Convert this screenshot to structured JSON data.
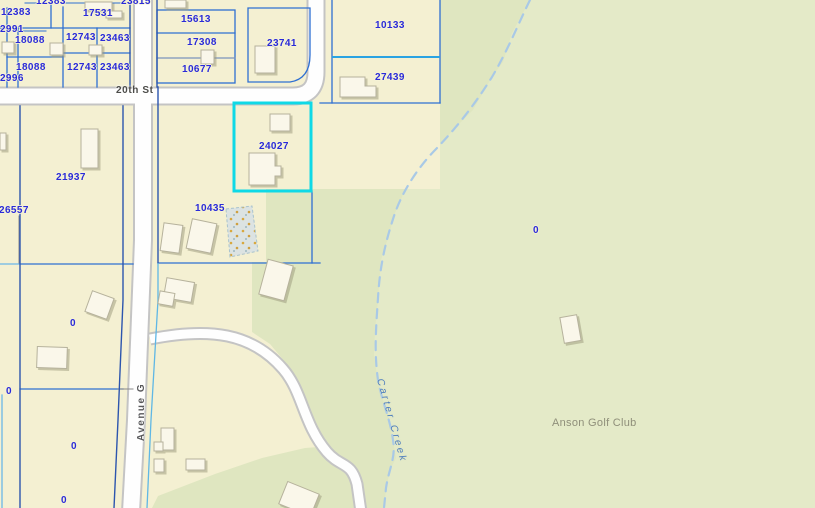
{
  "map": {
    "type": "gis-parcel-map",
    "parcel_labels": [
      "12383",
      "23815",
      "12383",
      "17531",
      "12991",
      "18088",
      "12743",
      "23463",
      "18088",
      "12743",
      "23463",
      "12996",
      "15613",
      "17308",
      "10677",
      "23741",
      "10133",
      "27439",
      "24027",
      "10435",
      "21937",
      "26557",
      "0",
      "0",
      "0",
      "0",
      "0"
    ],
    "street_labels": [
      "20th St",
      "Avenue G"
    ],
    "water_label": "Carter Creek",
    "place_label": "Anson Golf Club",
    "selected_parcel_id": "24027",
    "colors": {
      "parcel_fill": "#f4f0d2",
      "golf_fill": "#dfe6c0",
      "golf_fill_light": "#e4eac8",
      "selection_outline": "#0fd9e6",
      "parcel_line_blue": "#2e6fd2",
      "parcel_line_navy": "#2c55ae",
      "parcel_line_cyan": "#5fb7e5",
      "parcel_line_bright": "#2aa3e2",
      "parcel_number_text": "#2a2ad8",
      "street_text": "#4c4c49",
      "creek_line": "#a9c9e6",
      "creek_text": "#4e7dbd",
      "place_text": "#8f8f7a",
      "road_fill": "#ffffff",
      "road_casing": "#c4c4c4",
      "building_fill": "#faf7ea"
    }
  }
}
